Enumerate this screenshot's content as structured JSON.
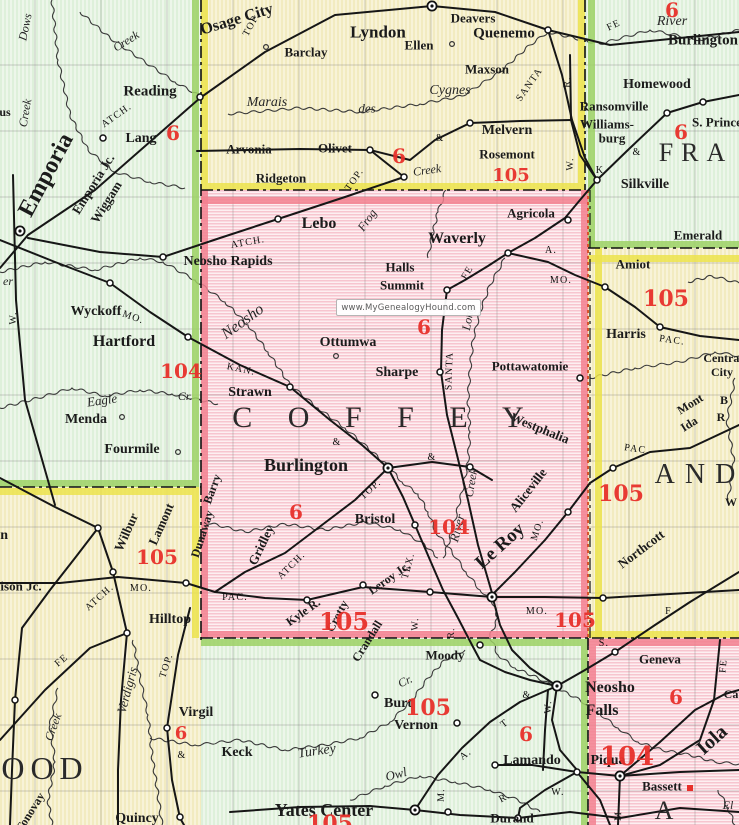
{
  "watermark": {
    "text": "www.MyGenealogyHound.com"
  },
  "colors": {
    "coffey_pink": "#f7c5cf",
    "county_mint": "#def0da",
    "county_cream": "#f2ebc0",
    "red_number": "#e8312b",
    "boundary_green": "#9cd164",
    "boundary_yellow": "#ece34c",
    "boundary_pink": "#f2808f",
    "railroad_black": "#161616"
  },
  "map": {
    "county_labels": [
      {
        "t": "C O F F E Y",
        "x": 385,
        "y": 418,
        "s": 30,
        "sp": 14
      },
      {
        "t": "FRA",
        "x": 696,
        "y": 153,
        "s": 26,
        "sp": 8
      },
      {
        "t": "AND",
        "x": 700,
        "y": 475,
        "s": 28,
        "sp": 10
      },
      {
        "t": "OOD",
        "x": 45,
        "y": 768,
        "s": 32,
        "sp": 6
      },
      {
        "t": "A",
        "x": 664,
        "y": 811,
        "s": 26
      }
    ],
    "towns": [
      {
        "t": "Reading",
        "x": 150,
        "y": 92,
        "s": 15,
        "b": 1
      },
      {
        "t": "Lang",
        "x": 141,
        "y": 139,
        "s": 14,
        "b": 1
      },
      {
        "t": "Emporia",
        "x": 46,
        "y": 175,
        "s": 24,
        "b": 1,
        "r": -62
      },
      {
        "t": "Emporia Jc.",
        "x": 93,
        "y": 184,
        "s": 13,
        "b": 1,
        "r": -58
      },
      {
        "t": "Wiggam",
        "x": 106,
        "y": 202,
        "s": 13,
        "b": 1,
        "r": -58
      },
      {
        "t": "Wyckoff",
        "x": 96,
        "y": 312,
        "s": 14,
        "b": 1
      },
      {
        "t": "Hartford",
        "x": 124,
        "y": 342,
        "s": 16,
        "b": 1
      },
      {
        "t": "Menda",
        "x": 86,
        "y": 420,
        "s": 14,
        "b": 1
      },
      {
        "t": "Fourmile",
        "x": 132,
        "y": 450,
        "s": 14,
        "b": 1
      },
      {
        "t": "Neosho Rapids",
        "x": 228,
        "y": 262,
        "s": 14,
        "b": 1
      },
      {
        "t": "us",
        "x": 5,
        "y": 112,
        "s": 12,
        "b": 1
      },
      {
        "t": "Madison",
        "x": -18,
        "y": 536,
        "s": 14,
        "b": 1
      },
      {
        "t": "Madison Jc.",
        "x": 8,
        "y": 586,
        "s": 13,
        "b": 1
      },
      {
        "t": "Osage City",
        "x": 237,
        "y": 20,
        "s": 16,
        "b": 1,
        "r": -17
      },
      {
        "t": "Lyndon",
        "x": 378,
        "y": 32,
        "s": 17,
        "b": 1
      },
      {
        "t": "Deavers",
        "x": 473,
        "y": 18,
        "s": 13,
        "b": 1
      },
      {
        "t": "Quenemo",
        "x": 504,
        "y": 34,
        "s": 15,
        "b": 1
      },
      {
        "t": "Ellen",
        "x": 419,
        "y": 45,
        "s": 13,
        "b": 1
      },
      {
        "t": "Maxson",
        "x": 487,
        "y": 69,
        "s": 13,
        "b": 1
      },
      {
        "t": "Barclay",
        "x": 306,
        "y": 52,
        "s": 13,
        "b": 1
      },
      {
        "t": "Melvern",
        "x": 507,
        "y": 131,
        "s": 14,
        "b": 1
      },
      {
        "t": "Rosemont",
        "x": 507,
        "y": 154,
        "s": 13,
        "b": 1
      },
      {
        "t": "Arvonia",
        "x": 249,
        "y": 149,
        "s": 13,
        "b": 1
      },
      {
        "t": "Olivet",
        "x": 335,
        "y": 148,
        "s": 13,
        "b": 1
      },
      {
        "t": "Ridgeton",
        "x": 281,
        "y": 178,
        "s": 13,
        "b": 1
      },
      {
        "t": "Burlington",
        "x": 703,
        "y": 41,
        "s": 15,
        "b": 1
      },
      {
        "t": "Homewood",
        "x": 657,
        "y": 85,
        "s": 14,
        "b": 1
      },
      {
        "t": "Ransomville",
        "x": 614,
        "y": 106,
        "s": 13,
        "b": 1
      },
      {
        "t": "Williams-",
        "x": 607,
        "y": 124,
        "s": 13,
        "b": 1
      },
      {
        "t": "burg",
        "x": 612,
        "y": 138,
        "s": 13,
        "b": 1
      },
      {
        "t": "S. Princeton",
        "x": 726,
        "y": 122,
        "s": 13,
        "b": 1
      },
      {
        "t": "Silkville",
        "x": 645,
        "y": 185,
        "s": 14,
        "b": 1
      },
      {
        "t": "Emerald",
        "x": 698,
        "y": 235,
        "s": 13,
        "b": 1
      },
      {
        "t": "Amiot",
        "x": 633,
        "y": 264,
        "s": 13,
        "b": 1
      },
      {
        "t": "Harris",
        "x": 626,
        "y": 335,
        "s": 14,
        "b": 1
      },
      {
        "t": "Central",
        "x": 723,
        "y": 358,
        "s": 12,
        "b": 1
      },
      {
        "t": "City",
        "x": 722,
        "y": 372,
        "s": 12,
        "b": 1
      },
      {
        "t": "Mont",
        "x": 690,
        "y": 404,
        "s": 12,
        "b": 1,
        "r": -32
      },
      {
        "t": "Ida",
        "x": 689,
        "y": 424,
        "s": 12,
        "b": 1,
        "r": -32
      },
      {
        "t": "B",
        "x": 724,
        "y": 400,
        "s": 12,
        "b": 1
      },
      {
        "t": "R",
        "x": 721,
        "y": 417,
        "s": 12,
        "b": 1
      },
      {
        "t": "Westphalia",
        "x": 540,
        "y": 428,
        "s": 13,
        "b": 1,
        "r": 22
      },
      {
        "t": "Northcott",
        "x": 641,
        "y": 549,
        "s": 13,
        "b": 1,
        "r": -37
      },
      {
        "t": "W",
        "x": 731,
        "y": 502,
        "s": 12,
        "b": 1
      },
      {
        "t": "Lebo",
        "x": 319,
        "y": 224,
        "s": 16,
        "b": 1
      },
      {
        "t": "Waverly",
        "x": 457,
        "y": 239,
        "s": 16,
        "b": 1
      },
      {
        "t": "Agricola",
        "x": 531,
        "y": 213,
        "s": 13,
        "b": 1
      },
      {
        "t": "Halls",
        "x": 400,
        "y": 267,
        "s": 13,
        "b": 1
      },
      {
        "t": "Summit",
        "x": 402,
        "y": 285,
        "s": 13,
        "b": 1
      },
      {
        "t": "Ottumwa",
        "x": 348,
        "y": 343,
        "s": 14,
        "b": 1
      },
      {
        "t": "Sharpe",
        "x": 397,
        "y": 373,
        "s": 14,
        "b": 1
      },
      {
        "t": "Pottawatomie",
        "x": 530,
        "y": 366,
        "s": 13,
        "b": 1
      },
      {
        "t": "Strawn",
        "x": 250,
        "y": 393,
        "s": 14,
        "b": 1
      },
      {
        "t": "Burlington",
        "x": 306,
        "y": 465,
        "s": 18,
        "b": 1
      },
      {
        "t": "Bristol",
        "x": 375,
        "y": 520,
        "s": 14,
        "b": 1
      },
      {
        "t": "Gridley",
        "x": 261,
        "y": 545,
        "s": 13,
        "b": 1,
        "r": -64
      },
      {
        "t": "Barry",
        "x": 212,
        "y": 489,
        "s": 12,
        "b": 1,
        "r": -70
      },
      {
        "t": "Dunaway",
        "x": 202,
        "y": 534,
        "s": 12,
        "b": 1,
        "r": -72
      },
      {
        "t": "Le Roy",
        "x": 500,
        "y": 546,
        "s": 19,
        "b": 1,
        "r": -42
      },
      {
        "t": "Aliceville",
        "x": 528,
        "y": 490,
        "s": 13,
        "b": 1,
        "r": -52
      },
      {
        "t": "Kyle R.",
        "x": 303,
        "y": 612,
        "s": 12,
        "b": 1,
        "r": -35
      },
      {
        "t": "Crotty",
        "x": 337,
        "y": 616,
        "s": 12,
        "b": 1,
        "r": -62
      },
      {
        "t": "Leroy Jc.",
        "x": 389,
        "y": 578,
        "s": 12,
        "b": 1,
        "r": -35
      },
      {
        "t": "Crandall",
        "x": 367,
        "y": 641,
        "s": 12,
        "b": 1,
        "r": -58
      },
      {
        "t": "Moody",
        "x": 445,
        "y": 655,
        "s": 13,
        "b": 1
      },
      {
        "t": "Wilbur",
        "x": 126,
        "y": 532,
        "s": 13,
        "b": 1,
        "r": -66
      },
      {
        "t": "Lamont",
        "x": 161,
        "y": 524,
        "s": 13,
        "b": 1,
        "r": -66
      },
      {
        "t": "Hilltop",
        "x": 170,
        "y": 620,
        "s": 14,
        "b": 1
      },
      {
        "t": "Virgil",
        "x": 196,
        "y": 713,
        "s": 14,
        "b": 1
      },
      {
        "t": "Quincy",
        "x": 137,
        "y": 819,
        "s": 14,
        "b": 1
      },
      {
        "t": "Tonovay",
        "x": 30,
        "y": 812,
        "s": 12,
        "b": 1,
        "r": -58
      },
      {
        "t": "Keck",
        "x": 237,
        "y": 753,
        "s": 14,
        "b": 1
      },
      {
        "t": "Burt",
        "x": 398,
        "y": 704,
        "s": 14,
        "b": 1
      },
      {
        "t": "Vernon",
        "x": 416,
        "y": 726,
        "s": 14,
        "b": 1
      },
      {
        "t": "Yates Center",
        "x": 324,
        "y": 810,
        "s": 18,
        "b": 1
      },
      {
        "t": "Neosho",
        "x": 610,
        "y": 688,
        "s": 16,
        "b": 1
      },
      {
        "t": "Falls",
        "x": 602,
        "y": 711,
        "s": 16,
        "b": 1
      },
      {
        "t": "Lamando",
        "x": 532,
        "y": 761,
        "s": 14,
        "b": 1
      },
      {
        "t": "Piqua",
        "x": 608,
        "y": 761,
        "s": 14,
        "b": 1
      },
      {
        "t": "Durand",
        "x": 512,
        "y": 818,
        "s": 13,
        "b": 1
      },
      {
        "t": "Geneva",
        "x": 660,
        "y": 659,
        "s": 13,
        "b": 1
      },
      {
        "t": "Iola",
        "x": 712,
        "y": 740,
        "s": 20,
        "b": 1,
        "r": -42
      },
      {
        "t": "Bassett",
        "x": 662,
        "y": 786,
        "s": 13,
        "b": 1
      },
      {
        "t": "Ca",
        "x": 731,
        "y": 694,
        "s": 12,
        "b": 1
      }
    ],
    "water": [
      {
        "t": "Marais",
        "x": 267,
        "y": 103,
        "s": 14
      },
      {
        "t": "des",
        "x": 367,
        "y": 108,
        "s": 13
      },
      {
        "t": "Cygnes",
        "x": 450,
        "y": 91,
        "s": 14
      },
      {
        "t": "River",
        "x": 672,
        "y": 22,
        "s": 14
      },
      {
        "t": "River",
        "x": 457,
        "y": 528,
        "s": 13,
        "r": -75
      },
      {
        "t": "er",
        "x": 8,
        "y": 281,
        "s": 12
      },
      {
        "t": "Neosho",
        "x": 243,
        "y": 322,
        "s": 16,
        "r": -36
      },
      {
        "t": "Frog",
        "x": 367,
        "y": 220,
        "s": 12,
        "r": -55
      },
      {
        "t": "Long",
        "x": 468,
        "y": 318,
        "s": 12,
        "r": -80
      },
      {
        "t": "Creek",
        "x": 471,
        "y": 483,
        "s": 12,
        "r": -80
      },
      {
        "t": "Eagle",
        "x": 102,
        "y": 400,
        "s": 13,
        "r": -8
      },
      {
        "t": "Cr.",
        "x": 185,
        "y": 396,
        "s": 12
      },
      {
        "t": "Cr.",
        "x": 405,
        "y": 681,
        "s": 12,
        "r": -25
      },
      {
        "t": "Dows",
        "x": 25,
        "y": 27,
        "s": 12,
        "r": -78
      },
      {
        "t": "Creek",
        "x": 25,
        "y": 113,
        "s": 12,
        "r": -80
      },
      {
        "t": "Creek",
        "x": 126,
        "y": 41,
        "s": 12,
        "r": -32
      },
      {
        "t": "Creek",
        "x": 427,
        "y": 170,
        "s": 12,
        "r": -8
      },
      {
        "t": "Verdigris",
        "x": 127,
        "y": 690,
        "s": 13,
        "r": -75
      },
      {
        "t": "Turkey",
        "x": 317,
        "y": 752,
        "s": 14,
        "r": -8
      },
      {
        "t": "Owl",
        "x": 396,
        "y": 774,
        "s": 13,
        "r": -15
      },
      {
        "t": "Creek",
        "x": 53,
        "y": 727,
        "s": 12,
        "r": -70
      },
      {
        "t": "El",
        "x": 728,
        "y": 805,
        "s": 12
      }
    ],
    "railroads": [
      {
        "t": "ATCH.",
        "x": 117,
        "y": 116,
        "r": -35
      },
      {
        "t": "TOP.",
        "x": 252,
        "y": 25,
        "r": -62
      },
      {
        "t": "TOP.",
        "x": 355,
        "y": 180,
        "r": -55
      },
      {
        "t": "TOP.",
        "x": 371,
        "y": 490,
        "r": -42
      },
      {
        "t": "TOP.",
        "x": 167,
        "y": 666,
        "r": -72
      },
      {
        "t": "ATCH.",
        "x": 248,
        "y": 243,
        "r": -10
      },
      {
        "t": "ATCH.",
        "x": 292,
        "y": 566,
        "r": -45
      },
      {
        "t": "ATCH.",
        "x": 100,
        "y": 598,
        "r": -42
      },
      {
        "t": "MO.",
        "x": 133,
        "y": 318,
        "r": 20
      },
      {
        "t": "MO.",
        "x": 561,
        "y": 281
      },
      {
        "t": "MO.",
        "x": 538,
        "y": 530,
        "r": -72
      },
      {
        "t": "MO.",
        "x": 537,
        "y": 612
      },
      {
        "t": "MO.",
        "x": 141,
        "y": 589
      },
      {
        "t": "KAN.",
        "x": 241,
        "y": 370,
        "r": 12
      },
      {
        "t": "SANTA",
        "x": 530,
        "y": 85,
        "r": -55
      },
      {
        "t": "SANTA",
        "x": 450,
        "y": 371,
        "r": -88
      },
      {
        "t": "FE",
        "x": 614,
        "y": 26,
        "r": -25
      },
      {
        "t": "FE",
        "x": 468,
        "y": 273,
        "r": -60
      },
      {
        "t": "FE",
        "x": 62,
        "y": 661,
        "r": -40
      },
      {
        "t": "FE",
        "x": 724,
        "y": 666,
        "r": -85
      },
      {
        "t": "PAC.",
        "x": 672,
        "y": 341,
        "r": 8
      },
      {
        "t": "PAC.",
        "x": 637,
        "y": 450,
        "r": 8
      },
      {
        "t": "PAC.",
        "x": 235,
        "y": 598
      },
      {
        "t": "TEX.",
        "x": 409,
        "y": 566,
        "r": -75
      },
      {
        "t": "A.",
        "x": 551,
        "y": 251
      },
      {
        "t": "A.",
        "x": 466,
        "y": 755,
        "r": -38
      },
      {
        "t": "T",
        "x": 505,
        "y": 724,
        "r": -38
      },
      {
        "t": "W.",
        "x": 14,
        "y": 318,
        "r": -88
      },
      {
        "t": "W.",
        "x": 571,
        "y": 164,
        "r": -88
      },
      {
        "t": "R.",
        "x": 568,
        "y": 82,
        "r": -88
      },
      {
        "t": "R.",
        "x": 452,
        "y": 633,
        "r": -88
      },
      {
        "t": "W.",
        "x": 416,
        "y": 624,
        "r": -88
      },
      {
        "t": "W.",
        "x": 549,
        "y": 707,
        "r": -88
      },
      {
        "t": "W.",
        "x": 558,
        "y": 793
      },
      {
        "t": "M.",
        "x": 442,
        "y": 795,
        "r": -88
      },
      {
        "t": "M",
        "x": 619,
        "y": 816,
        "r": -88
      },
      {
        "t": "R.",
        "x": 505,
        "y": 798,
        "r": -28
      },
      {
        "t": "F.",
        "x": 670,
        "y": 612
      },
      {
        "t": "S.",
        "x": 604,
        "y": 644
      },
      {
        "t": "K",
        "x": 600,
        "y": 171
      },
      {
        "t": "&",
        "x": 440,
        "y": 139
      },
      {
        "t": "&",
        "x": 637,
        "y": 153
      },
      {
        "t": "&",
        "x": 337,
        "y": 443
      },
      {
        "t": "&",
        "x": 432,
        "y": 458
      },
      {
        "t": "&",
        "x": 527,
        "y": 696
      },
      {
        "t": "&",
        "x": 182,
        "y": 756
      }
    ],
    "route_numbers": [
      {
        "t": "6",
        "x": 173,
        "y": 133,
        "s": 20
      },
      {
        "t": "6",
        "x": 399,
        "y": 156,
        "s": 20
      },
      {
        "t": "105",
        "x": 511,
        "y": 176,
        "s": 18
      },
      {
        "t": "6",
        "x": 672,
        "y": 10,
        "s": 20
      },
      {
        "t": "6",
        "x": 681,
        "y": 132,
        "s": 20
      },
      {
        "t": "6",
        "x": 424,
        "y": 327,
        "s": 20
      },
      {
        "t": "104",
        "x": 181,
        "y": 371,
        "s": 20
      },
      {
        "t": "105",
        "x": 666,
        "y": 299,
        "s": 22
      },
      {
        "t": "105",
        "x": 621,
        "y": 494,
        "s": 22
      },
      {
        "t": "104",
        "x": 449,
        "y": 527,
        "s": 20
      },
      {
        "t": "6",
        "x": 296,
        "y": 512,
        "s": 20
      },
      {
        "t": "105",
        "x": 157,
        "y": 557,
        "s": 20
      },
      {
        "t": "105",
        "x": 344,
        "y": 622,
        "s": 24
      },
      {
        "t": "105",
        "x": 575,
        "y": 620,
        "s": 20
      },
      {
        "t": "105",
        "x": 428,
        "y": 708,
        "s": 22
      },
      {
        "t": "104",
        "x": 627,
        "y": 757,
        "s": 26
      },
      {
        "t": "6",
        "x": 526,
        "y": 734,
        "s": 20
      },
      {
        "t": "6",
        "x": 676,
        "y": 697,
        "s": 20
      },
      {
        "t": "6",
        "x": 181,
        "y": 734,
        "s": 18
      },
      {
        "t": "105",
        "x": 330,
        "y": 824,
        "s": 22
      }
    ]
  }
}
